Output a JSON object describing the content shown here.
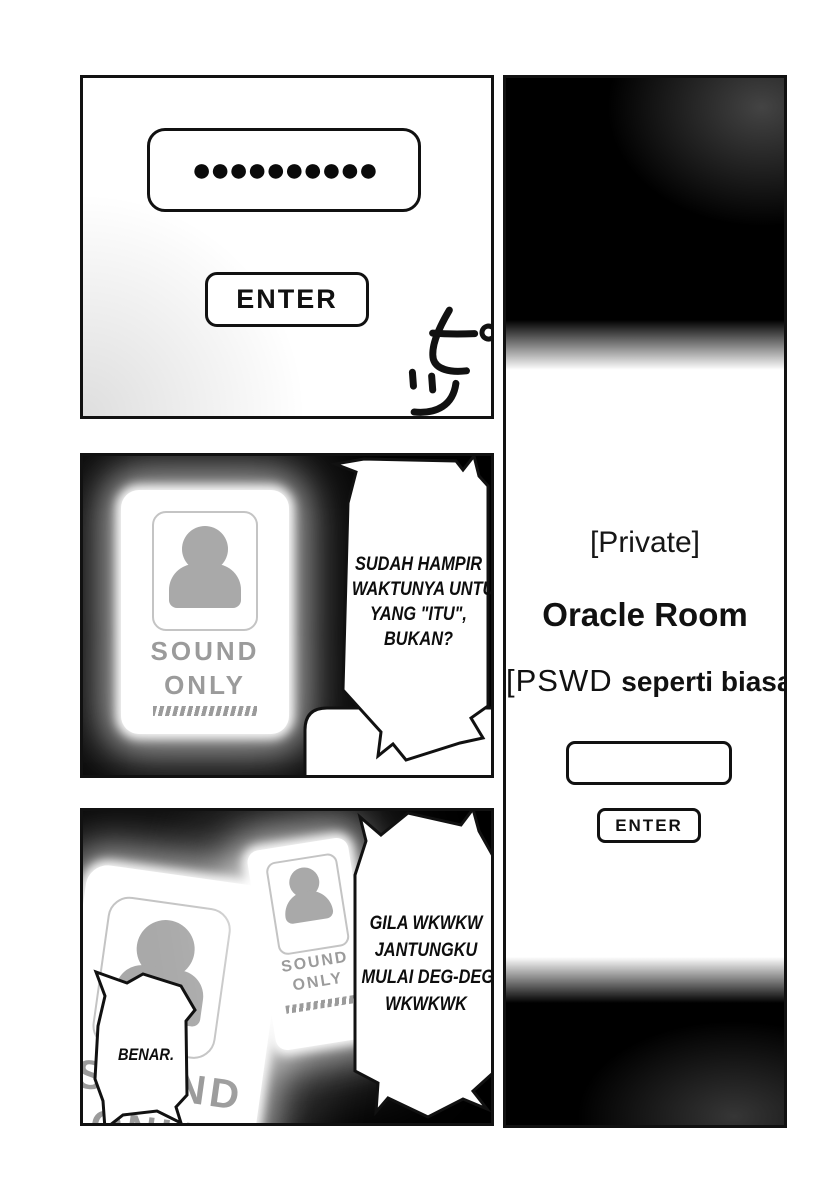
{
  "colors": {
    "ink": "#111111",
    "paper": "#ffffff",
    "panel_black": "#000000",
    "silhouette_gray": "#a9a9a9",
    "label_gray": "#9b9b9b"
  },
  "panels": {
    "login": {
      "password_value_masked": "●●●●●●●●●●",
      "password_dots_count": 10,
      "enter_label": "ENTER",
      "sfx_beep": "ピッ"
    },
    "oracle_room": {
      "private_label": "[Private]",
      "room_name": "Oracle Room",
      "password_hint_prefix": "[PSWD",
      "password_hint_bold": "seperti biasa",
      "password_hint_suffix": "]",
      "password_input_value": "",
      "enter_label": "ENTER"
    },
    "chat": {
      "card_label_line1": "SOUND",
      "card_label_line2": "ONLY",
      "bubble_lines": [
        "SUDAH HAMPIR",
        "WAKTUNYA UNTUK",
        "YANG \"ITU\",",
        "BUKAN?"
      ]
    },
    "reaction": {
      "left_card_label_line1": "SOUND",
      "left_card_label_line2": "ONLY",
      "right_card_label_line1": "SOUND",
      "right_card_label_line2": "ONLY",
      "bubble_lines": [
        "GILA WKWKW",
        "JANTUNGKU",
        "MULAI DEG-DEGAN",
        "WKWKWK"
      ],
      "reply_bubble_text": "BENAR."
    }
  }
}
